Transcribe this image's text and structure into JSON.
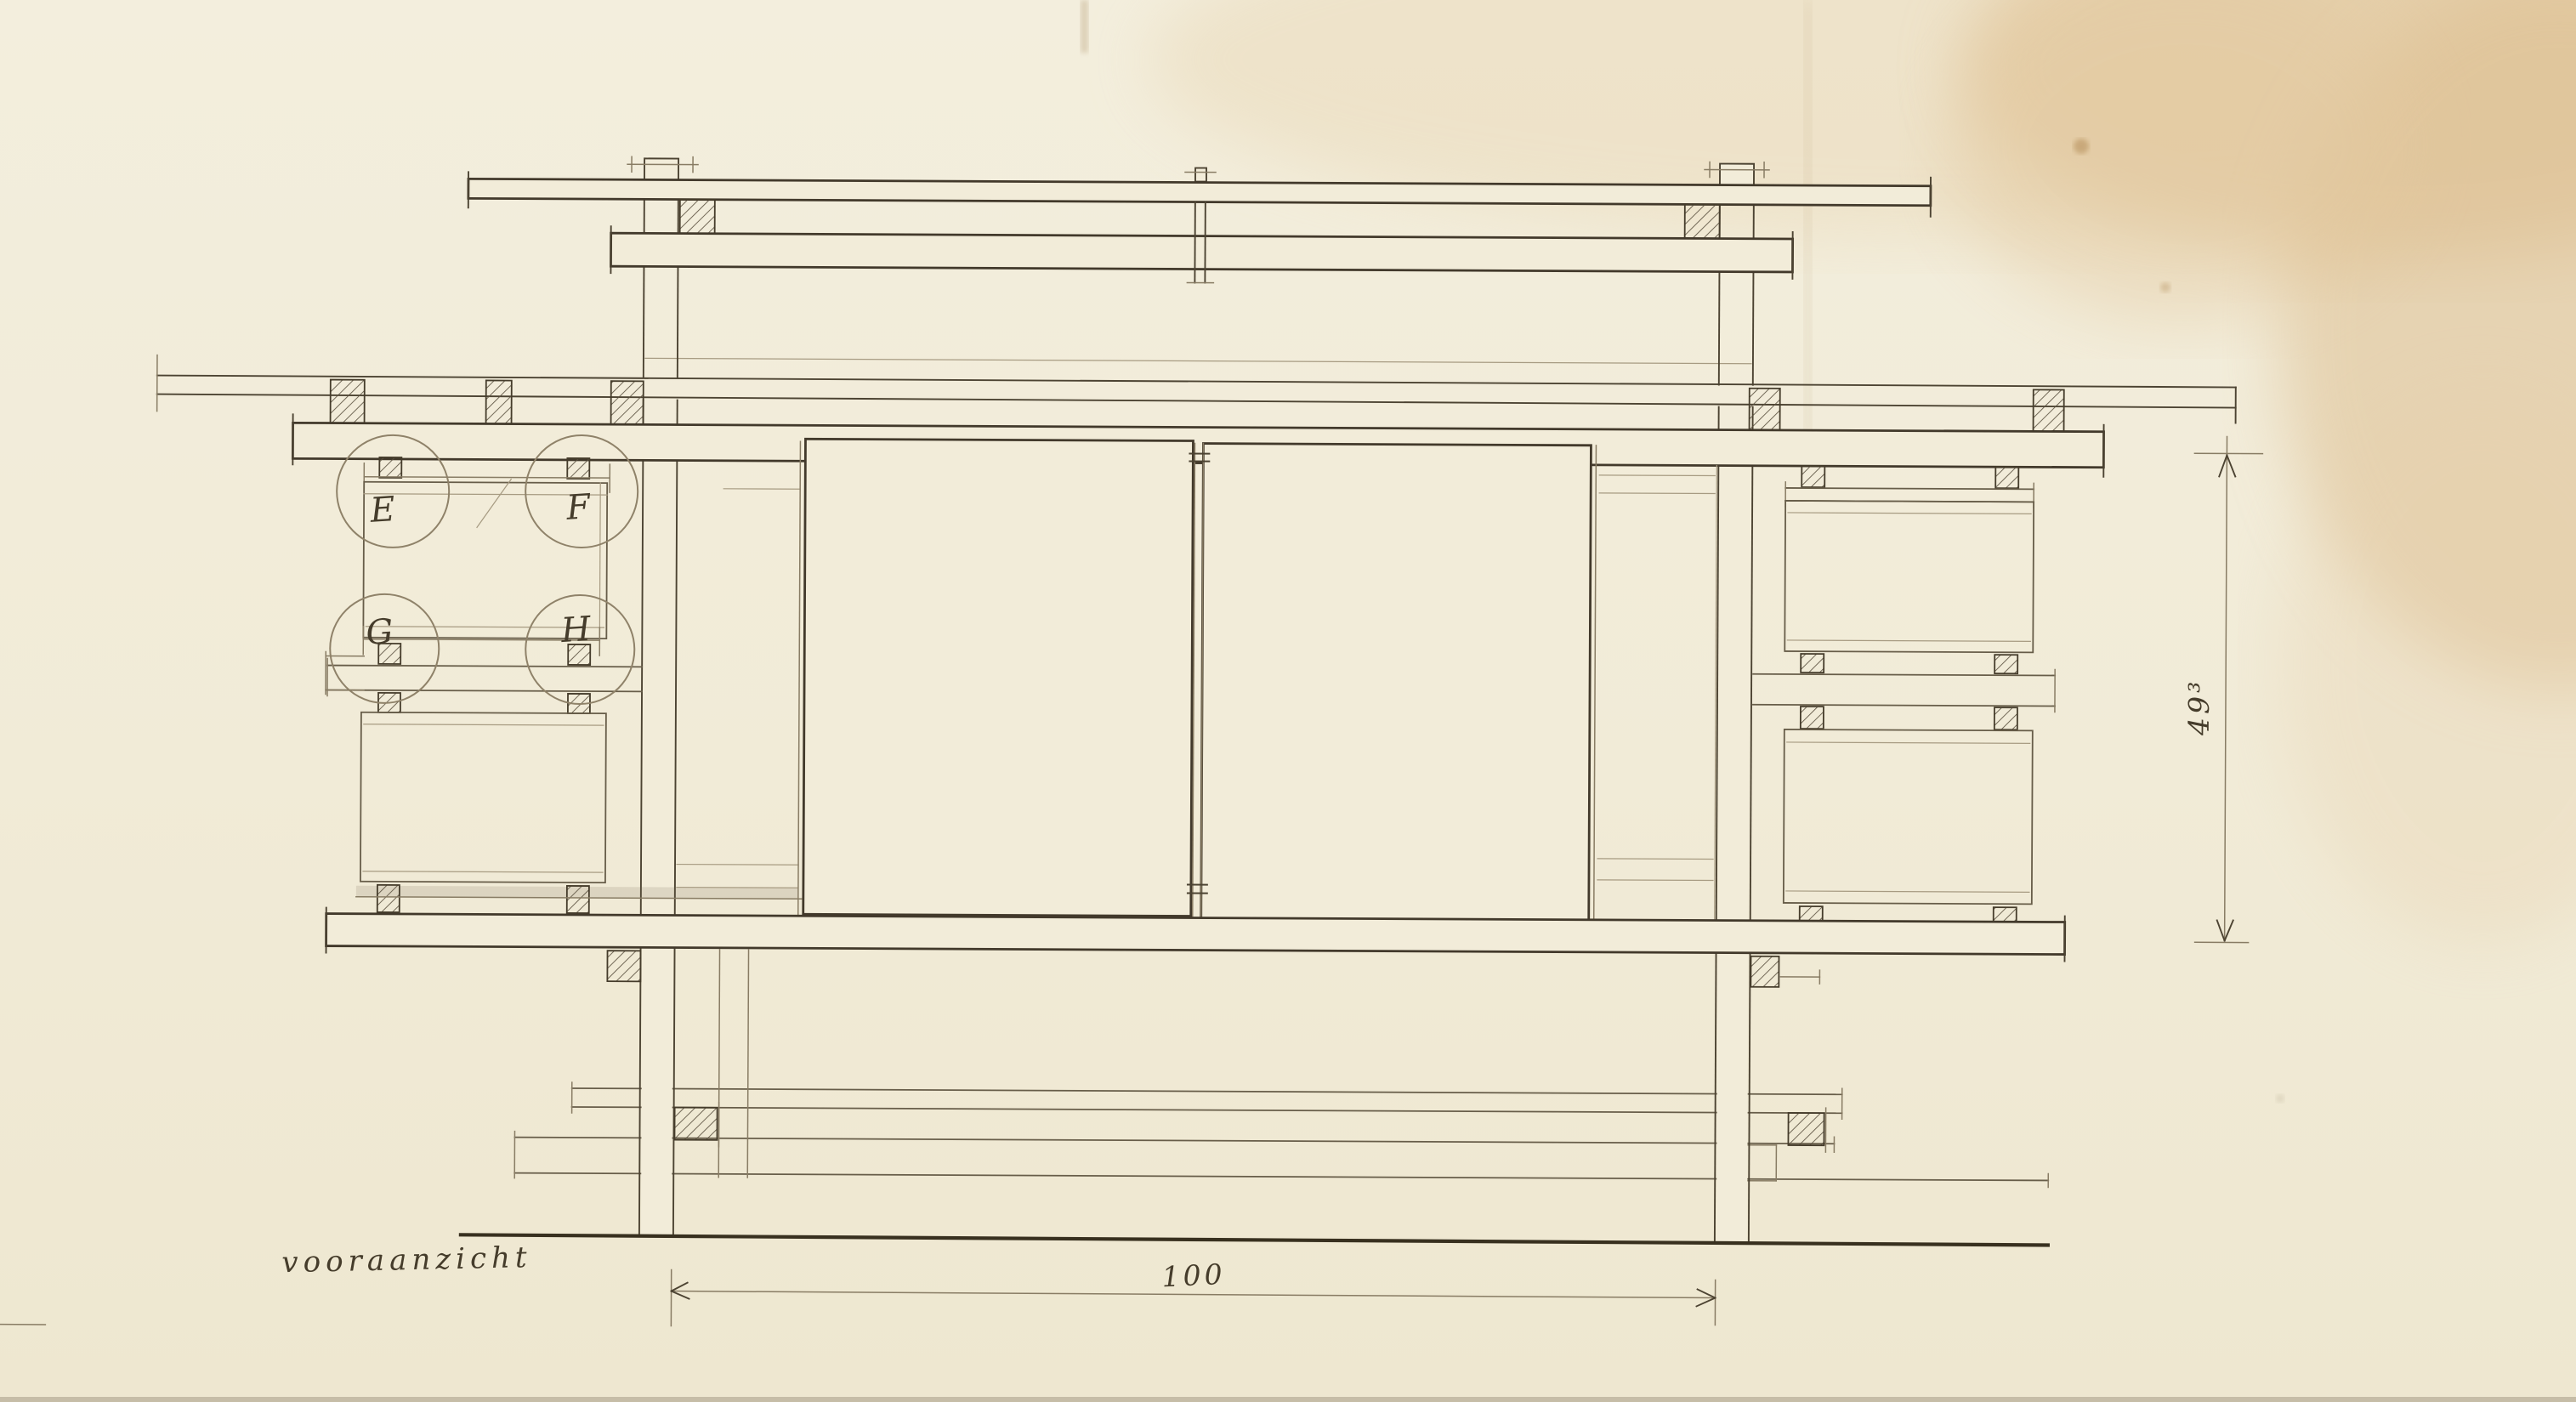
{
  "drawing": {
    "caption": "vooraanzicht",
    "detail_labels": {
      "e": "E",
      "f": "F",
      "g": "G",
      "h": "H"
    },
    "dimensions": {
      "width": "100",
      "height": "49³"
    },
    "colors": {
      "paper": "#f2ecd9",
      "ink": "#42392b",
      "pencil": "#8f8269",
      "stain": "#ddb98c"
    }
  }
}
